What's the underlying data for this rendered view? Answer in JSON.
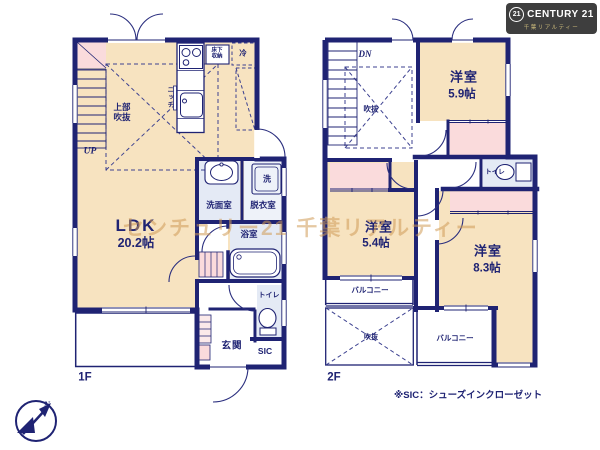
{
  "brand": {
    "badge_number": "21",
    "name": "CENTURY 21",
    "subtitle": "千葉リアルティー"
  },
  "watermark": "センチュリー21 千葉リアルティー",
  "footnote": "※SIC：シューズインクローゼット",
  "compass": {
    "north": "N"
  },
  "colors": {
    "wall": "#1f2373",
    "room_tan": "#f7e3c0",
    "closet_pink": "#fadbdc",
    "wet_area_blue": "#e4eaf5",
    "watermark": "#cf9a55",
    "logo_bg": "#3e3e3e",
    "logo_gold": "#c9b87a"
  },
  "floor1": {
    "floor_label": "1F",
    "ldk": {
      "name": "LDK",
      "size": "20.2帖"
    },
    "stairs": "UP",
    "open_ceiling": "上部吹抜",
    "niche": "ニッチ",
    "underfloor_storage": "床下収納",
    "refrigerator": "冷",
    "washroom": "洗面室",
    "dressing_room": "脱衣室",
    "washer": "洗",
    "bathroom": "浴室",
    "toilet": "トイレ",
    "entrance": "玄関",
    "shoe_closet": "SIC"
  },
  "floor2": {
    "floor_label": "2F",
    "stairs": "DN",
    "void_upper": "吹抜",
    "void_lower": "吹抜",
    "room_a": {
      "name": "洋室",
      "size": "5.9帖"
    },
    "room_b": {
      "name": "洋室",
      "size": "5.4帖"
    },
    "room_c": {
      "name": "洋室",
      "size": "8.3帖"
    },
    "toilet": "トイレ",
    "balcony_a": "バルコニー",
    "balcony_b": "バルコニー"
  }
}
